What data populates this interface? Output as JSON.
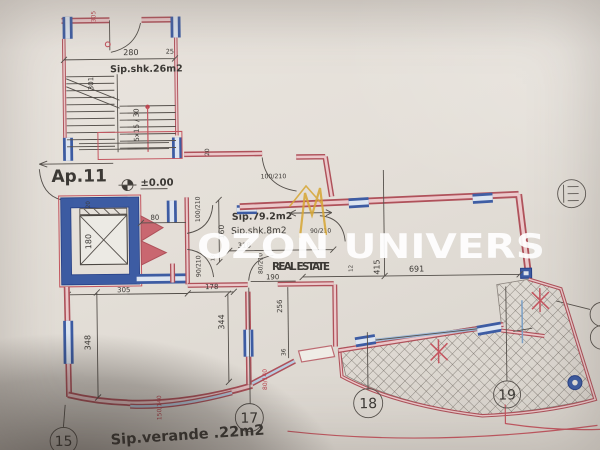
{
  "watermark": {
    "brand": "OZON UNIVERS",
    "tagline": "REAL ESTATE",
    "logo_color": "#d9a62e",
    "text_color": "#ffffff"
  },
  "plan": {
    "apartment": "Ap.11",
    "level_mark": "±0.00",
    "areas": {
      "stairwell": "Sip.shk.26m2",
      "living": "Sip.79.2m2",
      "stair_core": "Sip.shk.8m2",
      "veranda": "Sip.verande .22m2"
    },
    "grid_markers": {
      "g15": "15",
      "g17": "17",
      "g18": "18",
      "g19": "19"
    },
    "dims": {
      "d305_top": "305",
      "d280": "280",
      "d25": "25",
      "d301": "301",
      "stair_note": "5x15 / 30",
      "d20_wall": "20",
      "d20_shaft": "20",
      "d80": "80",
      "d180": "180",
      "door100a": "100/210",
      "door100b": "100/210",
      "d160": "160",
      "door90a": "90/210",
      "door90b": "90/210",
      "d13": "13",
      "d318": "318",
      "d178": "178",
      "d305_hall": "305",
      "door80": "80/210",
      "d190": "190",
      "d256": "256",
      "d36": "36",
      "d12": "12",
      "d344": "344",
      "d348": "348",
      "d415": "415",
      "d691": "691",
      "win150": "150/140",
      "win80": "80/140"
    },
    "colors": {
      "wall_red": "#b2505a",
      "wall_pink": "#ecc8ca",
      "window_blue": "#3c5ca6",
      "line_dark": "#55504b",
      "red_text": "#c0454f",
      "paper": "#e4dfd8"
    }
  }
}
